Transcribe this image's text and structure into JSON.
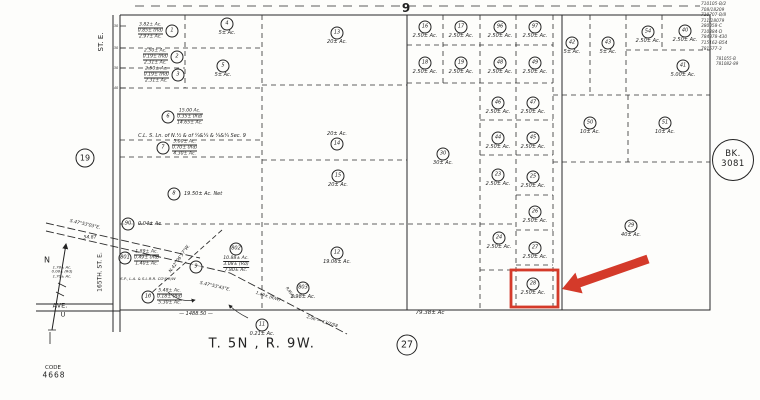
{
  "meta": {
    "township_label": "T. 5N , R. 9W.",
    "code_label": "CODE",
    "code_number": "4668",
    "section_number": "9",
    "section_circle": "27",
    "book_label": "BK.",
    "book_number": "3081",
    "adjacent_page": "19",
    "north_label": "N",
    "highlight_color": "#d43a2a",
    "ink_color": "#1f1f1f"
  },
  "corner_refs": [
    "710105-B/2",
    "708/18209",
    "710707-B/8",
    "711/18079",
    "380058-C",
    "710384-D",
    "784878-430",
    "715162-B54",
    "781577-3"
  ],
  "corner_refs2": [
    "781055-B",
    "781082-89"
  ],
  "map": {
    "highlight": {
      "parcel": "28",
      "color": "#d43a2a"
    },
    "parcels": [
      {
        "num": "1",
        "cx": 172,
        "cy": 31,
        "lines": [
          "3.82± Ac.",
          "0.85± (Rd)",
          "2.97± Ac."
        ],
        "lines_pos": "left"
      },
      {
        "num": "2",
        "cx": 177,
        "cy": 57,
        "lines": [
          "2.50± Ac.",
          "0.19± (Rd)",
          "2.31± Ac."
        ],
        "lines_pos": "left"
      },
      {
        "num": "3",
        "cx": 178,
        "cy": 75,
        "lines": [
          "2.50± Ac.",
          "0.19± (Rd)",
          "2.31± Ac."
        ],
        "lines_pos": "left"
      },
      {
        "num": "4",
        "cx": 227,
        "cy": 24,
        "label": "5± Ac."
      },
      {
        "num": "5",
        "cx": 223,
        "cy": 66,
        "label": "5± Ac."
      },
      {
        "num": "6",
        "cx": 168,
        "cy": 117,
        "lines": [
          "15.00 Ac.",
          "0.35± (Rd)",
          "14.65± Ac."
        ],
        "lines_pos": "right"
      },
      {
        "num": "7",
        "cx": 163,
        "cy": 148,
        "lines": [
          "5.00± Ac.",
          "0.70± (Rd)",
          "4.30± Ac."
        ],
        "lines_pos": "right"
      },
      {
        "num": "8",
        "cx": 174,
        "cy": 194,
        "label": "19.50± Ac. Net",
        "label_pos": "right"
      },
      {
        "num": "90",
        "cx": 128,
        "cy": 224,
        "label": "0.04± Ac.",
        "label_pos": "right"
      },
      {
        "num": "13",
        "cx": 337,
        "cy": 33,
        "label": "20± Ac."
      },
      {
        "num": "14",
        "cx": 337,
        "cy": 144,
        "label": "20± Ac.",
        "label_pos": "above"
      },
      {
        "num": "15",
        "cx": 338,
        "cy": 176,
        "label": "20± Ac."
      },
      {
        "num": "12",
        "cx": 337,
        "cy": 253,
        "label": "19.06± Ac."
      },
      {
        "num": "30",
        "cx": 443,
        "cy": 154,
        "label": "30± Ac."
      },
      {
        "num": "16",
        "cx": 425,
        "cy": 27,
        "label": "2.50± Ac."
      },
      {
        "num": "17",
        "cx": 461,
        "cy": 27,
        "label": "2.50± Ac."
      },
      {
        "num": "96",
        "cx": 500,
        "cy": 27,
        "label": "2.50± Ac."
      },
      {
        "num": "97",
        "cx": 535,
        "cy": 27,
        "label": "2.50± Ac."
      },
      {
        "num": "18",
        "cx": 425,
        "cy": 63,
        "label": "2.50± Ac."
      },
      {
        "num": "19",
        "cx": 461,
        "cy": 63,
        "label": "2.50± Ac."
      },
      {
        "num": "48",
        "cx": 500,
        "cy": 63,
        "label": "2.50± Ac."
      },
      {
        "num": "49",
        "cx": 535,
        "cy": 63,
        "label": "2.50± Ac."
      },
      {
        "num": "46",
        "cx": 498,
        "cy": 103,
        "label": "2.50± Ac."
      },
      {
        "num": "47",
        "cx": 533,
        "cy": 103,
        "label": "2.50± Ac."
      },
      {
        "num": "44",
        "cx": 498,
        "cy": 138,
        "label": "2.50± Ac."
      },
      {
        "num": "45",
        "cx": 533,
        "cy": 138,
        "label": "2.50± Ac."
      },
      {
        "num": "23",
        "cx": 498,
        "cy": 175,
        "label": "2.50± Ac."
      },
      {
        "num": "25",
        "cx": 533,
        "cy": 177,
        "label": "2.50± Ac."
      },
      {
        "num": "26",
        "cx": 535,
        "cy": 212,
        "label": "2.50± Ac."
      },
      {
        "num": "24",
        "cx": 499,
        "cy": 238,
        "label": "2.50± Ac."
      },
      {
        "num": "27",
        "cx": 535,
        "cy": 248,
        "label": "2.50± Ac."
      },
      {
        "num": "28",
        "cx": 533,
        "cy": 284,
        "label": "2.50± Ac.",
        "highlight": true
      },
      {
        "num": "42",
        "cx": 572,
        "cy": 43,
        "label": "5± Ac."
      },
      {
        "num": "43",
        "cx": 608,
        "cy": 43,
        "label": "5± Ac."
      },
      {
        "num": "54",
        "cx": 648,
        "cy": 32,
        "label": "2.50± Ac."
      },
      {
        "num": "40",
        "cx": 685,
        "cy": 31,
        "label": "2.50± Ac."
      },
      {
        "num": "41",
        "cx": 683,
        "cy": 66,
        "label": "5.00± Ac."
      },
      {
        "num": "50",
        "cx": 590,
        "cy": 123,
        "label": "10± Ac."
      },
      {
        "num": "51",
        "cx": 665,
        "cy": 123,
        "label": "10± Ac."
      },
      {
        "num": "29",
        "cx": 631,
        "cy": 226,
        "label": "40± Ac."
      },
      {
        "num": "801",
        "cx": 125,
        "cy": 258,
        "lines": [
          "1.89± Ac.",
          "0.49± (Rd)",
          "1.40± Ac."
        ],
        "lines_pos": "right"
      },
      {
        "num": "802",
        "cx": 236,
        "cy": 249,
        "lines": [
          "10.88± Ac.",
          "3.08± (Rd)",
          "7.80± Ac."
        ],
        "lines_pos": "below"
      },
      {
        "num": "803",
        "cx": 303,
        "cy": 288,
        "label": "2.98± Ac."
      },
      {
        "num": "9",
        "cx": 196,
        "cy": 267
      },
      {
        "num": "10",
        "cx": 148,
        "cy": 297,
        "lines": [
          "5.48± Ac.",
          "0.18± (Rd)",
          "5.30± Ac."
        ],
        "lines_pos": "right"
      },
      {
        "num": "11",
        "cx": 262,
        "cy": 325,
        "label": "0.21± Ac."
      }
    ],
    "annotations": [
      {
        "name": "section-number",
        "text": "9",
        "x": 406,
        "y": 9,
        "size": 12,
        "bold": true,
        "upright": true
      },
      {
        "name": "township-range-label",
        "text": "T. 5N , R. 9W.",
        "x": 262,
        "y": 345,
        "size": 13,
        "upright": true,
        "spacing": 1.5
      },
      {
        "name": "code-label",
        "text": "CODE",
        "x": 53,
        "y": 368,
        "size": 5.5,
        "upright": true
      },
      {
        "name": "code-number",
        "text": "4668",
        "x": 54,
        "y": 376,
        "size": 7.5,
        "upright": true,
        "spacing": 1
      },
      {
        "name": "street-label-st-e",
        "text": "ST. E.",
        "x": 101,
        "y": 42,
        "size": 7,
        "rot": -90,
        "upright": true
      },
      {
        "name": "street-label-165th",
        "text": "165TH.  ST. E.",
        "x": 101,
        "y": 272,
        "size": 6,
        "rot": -90,
        "upright": true
      },
      {
        "name": "avenue-label",
        "text": "AVE.",
        "x": 60,
        "y": 306,
        "size": 6.5,
        "upright": true
      },
      {
        "name": "avenue-letter",
        "text": "U",
        "x": 63,
        "y": 315,
        "size": 6.5,
        "upright": true
      },
      {
        "name": "north-label",
        "text": "N",
        "x": 47,
        "y": 260,
        "size": 8,
        "upright": true
      },
      {
        "name": "dimension-54-87",
        "text": "54.87",
        "x": 90,
        "y": 238,
        "size": 4.5
      },
      {
        "name": "bearing-s475303e",
        "text": "S.47°53'03\"E.",
        "x": 85,
        "y": 225,
        "size": 4.5,
        "rot": 13
      },
      {
        "name": "bearing-s475343e",
        "text": "S.47°53'43\"E.",
        "x": 215,
        "y": 287,
        "size": 4.5,
        "rot": 13
      },
      {
        "name": "bearing-n420657w",
        "text": "N.42°06'57\"W.",
        "x": 180,
        "y": 259,
        "size": 4.5,
        "rot": -55
      },
      {
        "name": "railroad-rw-label",
        "text": "S.P., L.A. & S.L.R.R. CO'S R/W",
        "x": 148,
        "y": 279,
        "size": 3.8
      },
      {
        "name": "rw-dimension",
        "text": "1.49± (R/W)",
        "x": 268,
        "y": 297,
        "size": 4.2,
        "rot": 17
      },
      {
        "name": "recording-note",
        "text": "2.06 — 13/7/58",
        "x": 322,
        "y": 322,
        "size": 4.2,
        "rot": 17
      },
      {
        "name": "roadway-note",
        "text": "R/WAY",
        "x": 290,
        "y": 293,
        "size": 4,
        "rot": 55
      },
      {
        "name": "dimension-1488-50",
        "text": "—  1488.50  —",
        "x": 196,
        "y": 315,
        "size": 5
      },
      {
        "name": "dimension-79-38",
        "text": "79.38± Ac",
        "x": 430,
        "y": 313,
        "size": 5.5
      },
      {
        "name": "section-note",
        "text": "C.L. S. Ln. of N.½ & of ¼&¼ & ¼&¼ Sec. 9",
        "x": 192,
        "y": 137,
        "size": 5
      },
      {
        "name": "tick-number",
        "text": "30",
        "x": 116,
        "y": 26,
        "size": 3.5
      },
      {
        "name": "tick-number",
        "text": "30",
        "x": 116,
        "y": 48,
        "size": 3.5
      },
      {
        "name": "tick-number",
        "text": "30",
        "x": 116,
        "y": 68,
        "size": 3.5
      },
      {
        "name": "tick-number",
        "text": "40",
        "x": 116,
        "y": 88,
        "size": 3.5
      },
      {
        "name": "roadside-acreage-stack",
        "lines": [
          "1.78± Ac.",
          "0.08± (Rd)",
          "1.70± Ac."
        ],
        "x": 62,
        "y": 272,
        "size": 3.8
      }
    ]
  }
}
